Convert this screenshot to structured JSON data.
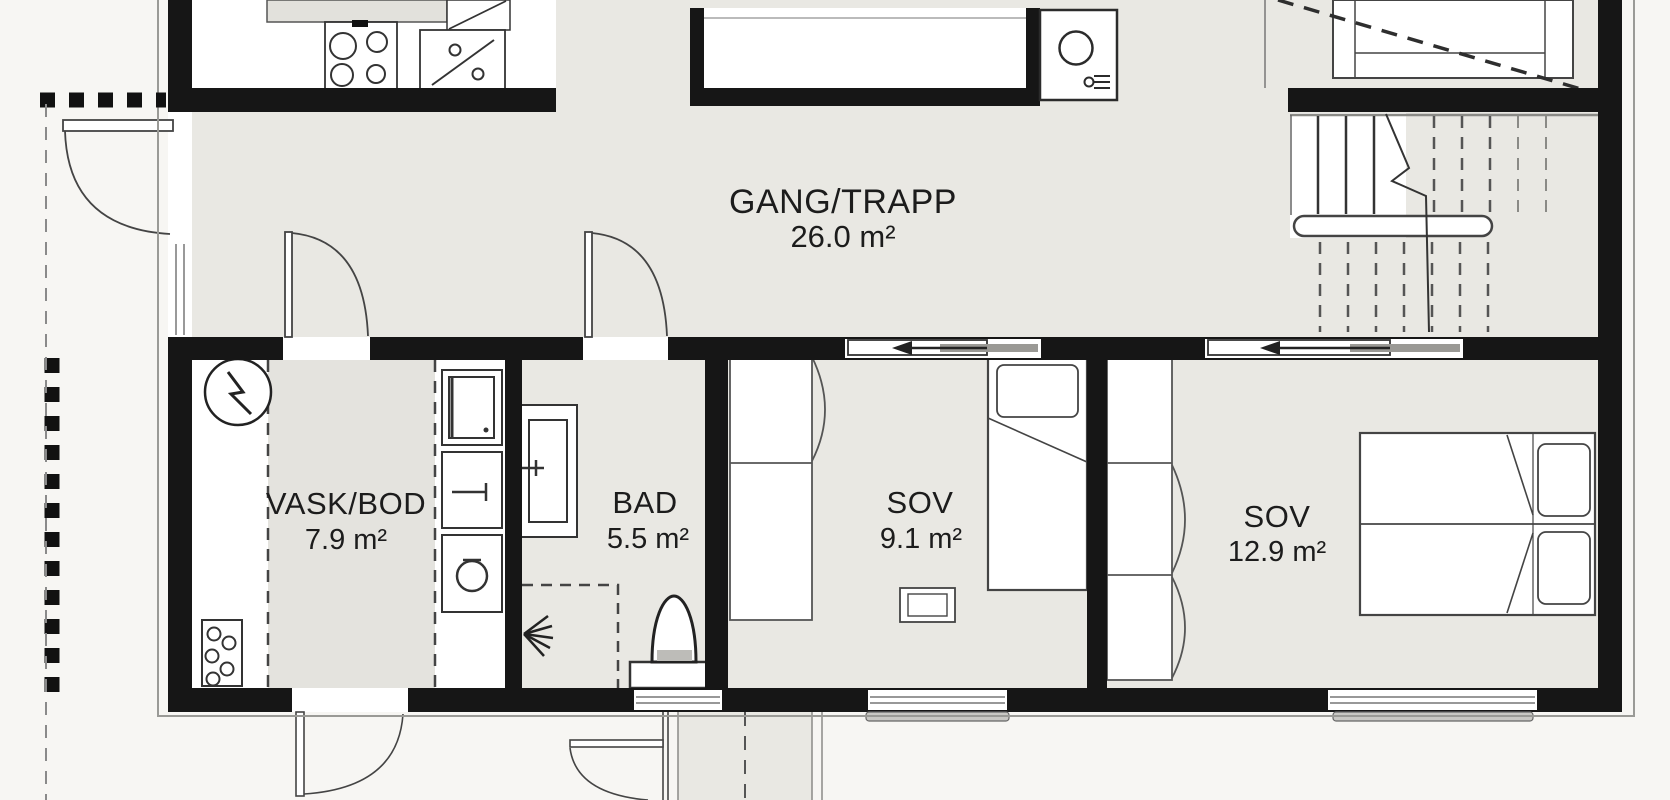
{
  "plan": {
    "type": "floor-plan",
    "language": "Norwegian",
    "rooms": {
      "hall": {
        "name": "GANG/TRAPP",
        "area": "26.0 m²"
      },
      "laundry": {
        "name": "VASK/BOD",
        "area": "7.9 m²"
      },
      "bath": {
        "name": "BAD",
        "area": "5.5 m²"
      },
      "bedroom_small": {
        "name": "SOV",
        "area": "9.1 m²"
      },
      "bedroom_large": {
        "name": "SOV",
        "area": "12.9 m²"
      }
    },
    "fixtures": [
      "cooktop-icon",
      "kitchen-sink-icon",
      "round-basin-icon",
      "tap-icon",
      "electrical-panel-icon",
      "utility-sink-icon",
      "washing-machine-icon",
      "floor-drain-icon",
      "vanity-sink-icon",
      "shower-head-icon",
      "toilet-icon",
      "staircase",
      "wardrobe",
      "single-bed",
      "double-bed",
      "sliding-door-arrow-icon"
    ],
    "colors": {
      "wall": "#161616",
      "floor": "#e9e8e3",
      "zone_gray": "#e4e3de",
      "exterior": "#f7f6f3",
      "line_dark": "#2b2b2b",
      "line_mid": "#555555",
      "line_light": "#999999",
      "sill": "#c9c8c4",
      "door_panel_gray": "#9a9995"
    }
  }
}
